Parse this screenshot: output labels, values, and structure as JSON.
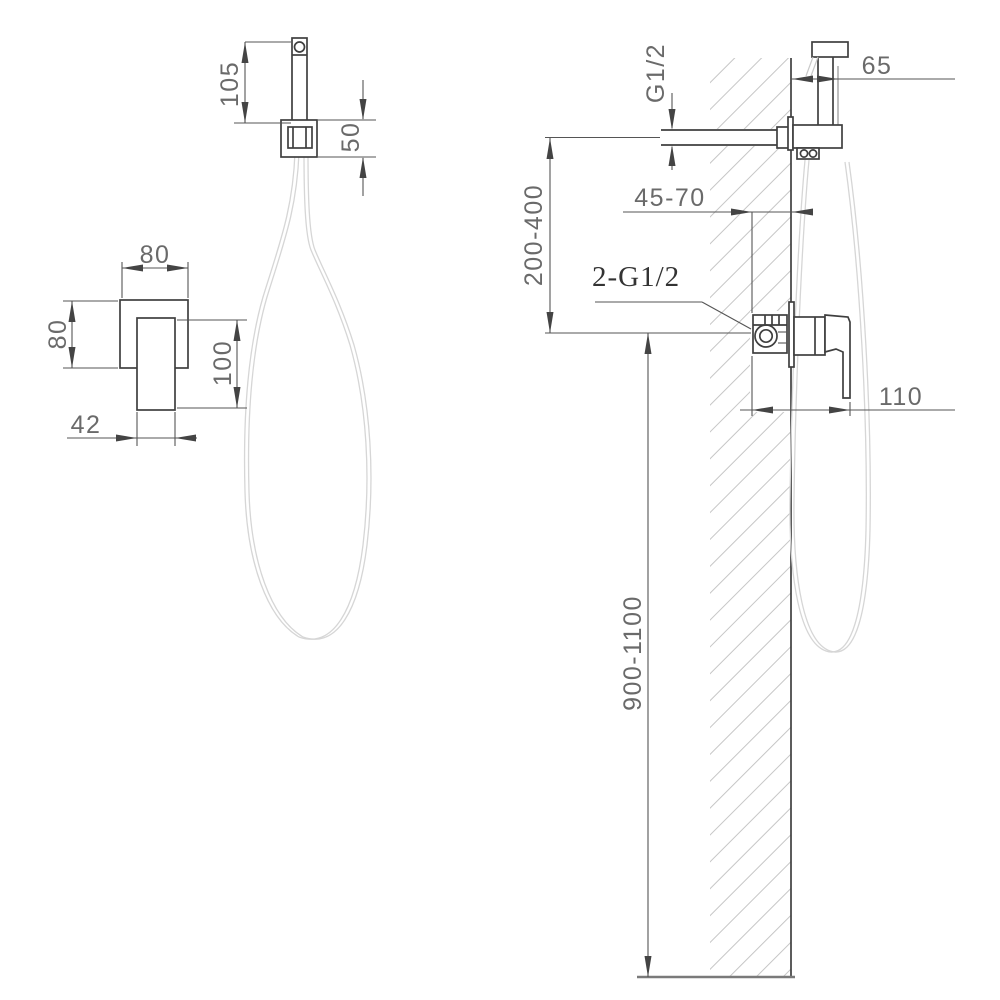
{
  "drawing": {
    "front_view": {
      "sprayer_length": "105",
      "bracket_height": "50",
      "mixer_body_width": "80",
      "mixer_body_height": "80",
      "handle_length": "100",
      "handle_width": "42"
    },
    "side_view": {
      "inlet_thread": "G1/2",
      "sprayer_wall_offset": "65",
      "inlet_to_mixer_height": "200-400",
      "recess_depth": "45-70",
      "connections_label": "2-G1/2",
      "handle_projection": "110",
      "mixer_mounting_height": "900-1100"
    },
    "colors": {
      "object_line": "#3f3f3f",
      "dimension_line": "#555555",
      "dimension_text": "#6a6a6a",
      "hatch": "#c6c6c6",
      "hose": "#d6d6d6",
      "background": "#ffffff"
    }
  }
}
